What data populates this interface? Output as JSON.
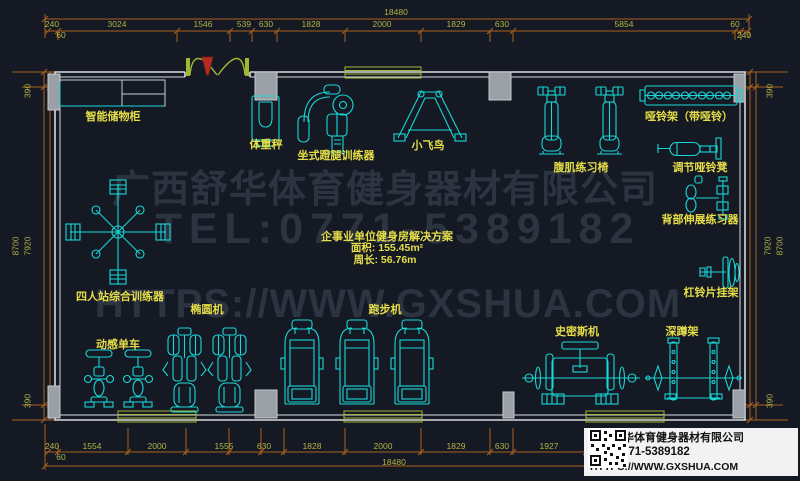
{
  "watermark": {
    "company": "广西舒华体育健身器材有限公司",
    "tel": "TEL:0771-5389182",
    "url": "HTTPS://WWW.GXSHUA.COM"
  },
  "info_box": {
    "company": "广西舒华体育健身器材有限公司",
    "tel": "TEL:0771-5389182",
    "url": "HTTPS://WWW.GXSHUA.COM",
    "qr_icon": "qr-code"
  },
  "solution": {
    "title": "企事业单位健身房解决方案",
    "area": "面积: 155.45m²",
    "perimeter": "周长: 56.76m"
  },
  "labels": {
    "storage": "智能储物柜",
    "scale": "体重秤",
    "leg_press": "坐式蹬腿训练器",
    "fly": "小飞鸟",
    "dumbbell_rack": "哑铃架（带哑铃）",
    "ab_chair": "腹肌练习椅",
    "adj_bench": "调节哑铃凳",
    "back_ext": "背部伸展练习器",
    "plate_rack": "杠铃片挂架",
    "multi_station": "四人站综合训练器",
    "elliptical": "椭圆机",
    "spin_bike": "动感单车",
    "treadmill": "跑步机",
    "smith": "史密斯机",
    "squat": "深蹲架"
  },
  "dims": {
    "top_total": "18480",
    "top": [
      "240",
      "60",
      "3024",
      "1546",
      "539",
      "630",
      "1828",
      "2000",
      "1829",
      "630",
      "5854",
      "60",
      "240"
    ],
    "bottom_total": "18480",
    "bottom": [
      "240",
      "60",
      "1554",
      "2000",
      "1555",
      "630",
      "1828",
      "2000",
      "1829",
      "630",
      "1927"
    ],
    "left": [
      "390",
      "8700",
      "7920",
      "390"
    ],
    "right": [
      "390",
      "7920",
      "8700",
      "390"
    ]
  },
  "colors": {
    "background": "#151923",
    "equipment_cyan": "#19d7d7",
    "dimension_line_orange": "#a8611e",
    "dimension_text_olive": "#b3b346",
    "label_yellow": "#e5de48",
    "wall_white": "#d8dce0",
    "window_green": "#a4b53a",
    "door_green": "#9fb832",
    "door_red": "#b52b20",
    "watermark_gray": "#2c3442",
    "info_box_bg": "#f2f2f2"
  }
}
